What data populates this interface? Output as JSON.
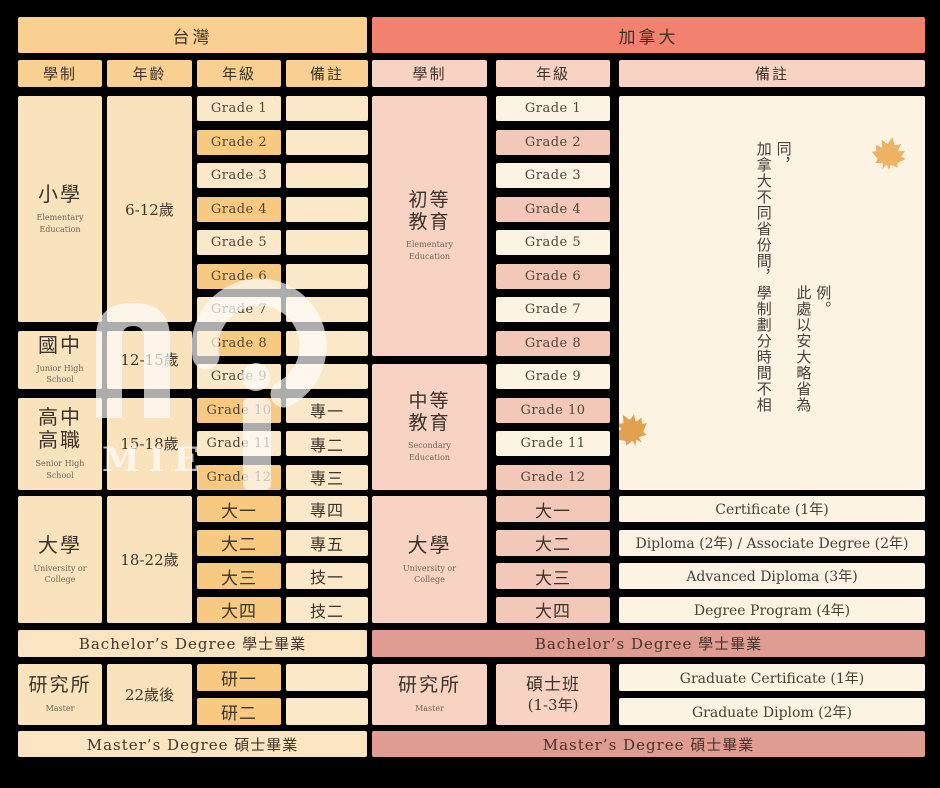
{
  "colors": {
    "background": "#000000",
    "taiwan_header": "#FAD092",
    "taiwan_orange": "#F8C981",
    "taiwan_cream": "#FBE8C8",
    "taiwan_block": "#F9E2BC",
    "taiwan_rowband": "#FAE4C1",
    "canada_header": "#F2816F",
    "canada_pink": "#F8D3C3",
    "canada_pink_deep": "#F4C8B8",
    "canada_cream": "#FDF3E2",
    "canada_rose": "#DF9C92",
    "maple_leaf": "#E8A852"
  },
  "watermark": {
    "text": "MIE"
  },
  "taiwan": {
    "title": "台灣",
    "columns": [
      "學制",
      "年齡",
      "年級",
      "備註"
    ],
    "grades": [
      "Grade 1",
      "Grade 2",
      "Grade 3",
      "Grade 4",
      "Grade 5",
      "Grade 6",
      "Grade 7",
      "Grade 8",
      "Grade 9",
      "Grade 10",
      "Grade 11",
      "Grade 12"
    ],
    "grade_notes": [
      "",
      "",
      "",
      "",
      "",
      "",
      "",
      "",
      "",
      "專一",
      "專二",
      "專三"
    ],
    "levels": {
      "elementary": {
        "name": "小學",
        "sub": "Elementary Education",
        "age": "6-12歲"
      },
      "junior": {
        "name": "國中",
        "sub": "Junior High School",
        "age": "12-15歲"
      },
      "senior": {
        "line1": "高中",
        "line2": "高職",
        "sub": "Senior High School",
        "age": "15-18歲"
      },
      "university": {
        "name": "大學",
        "sub": "University or College",
        "age": "18-22歲"
      },
      "graduate": {
        "name": "研究所",
        "sub": "Master",
        "age": "22歲後"
      }
    },
    "uni_grades": [
      "大一",
      "大二",
      "大三",
      "大四"
    ],
    "uni_notes": [
      "專四",
      "專五",
      "技一",
      "技二"
    ],
    "grad_grades": [
      "研一",
      "研二"
    ],
    "grad_notes": [
      "",
      ""
    ],
    "bachelor_row": "Bachelor’s Degree 學士畢業",
    "master_row": "Master’s Degree 碩士畢業"
  },
  "canada": {
    "title": "加拿大",
    "columns": [
      "學制",
      "年級",
      "備註"
    ],
    "grades": [
      "Grade 1",
      "Grade 2",
      "Grade 3",
      "Grade 4",
      "Grade 5",
      "Grade 6",
      "Grade 7",
      "Grade 8",
      "Grade 9",
      "Grade 10",
      "Grade 11",
      "Grade 12"
    ],
    "levels": {
      "elementary": {
        "line1": "初等",
        "line2": "教育",
        "sub": "Elementary Education"
      },
      "secondary": {
        "line1": "中等",
        "line2": "教育",
        "sub": "Secondary Education"
      },
      "university": {
        "name": "大學",
        "sub": "University or College"
      },
      "graduate": {
        "name": "研究所",
        "sub": "Master"
      },
      "master_program": {
        "line1": "碩士班",
        "line2": "(1-3年)"
      }
    },
    "note_vertical": {
      "col1": "加拿大不同省份間，學制劃分時間不相同，",
      "col2": "此處以安大略省為例。"
    },
    "uni_grades": [
      "大一",
      "大二",
      "大三",
      "大四"
    ],
    "uni_notes": [
      "Certificate (1年)",
      "Diploma (2年) / Associate Degree (2年)",
      "Advanced Diploma (3年)",
      "Degree Program (4年)"
    ],
    "grad_notes": [
      "Graduate Certificate (1年)",
      "Graduate Diplom (2年)"
    ],
    "bachelor_row": "Bachelor’s Degree 學士畢業",
    "master_row": "Master’s Degree 碩士畢業"
  }
}
